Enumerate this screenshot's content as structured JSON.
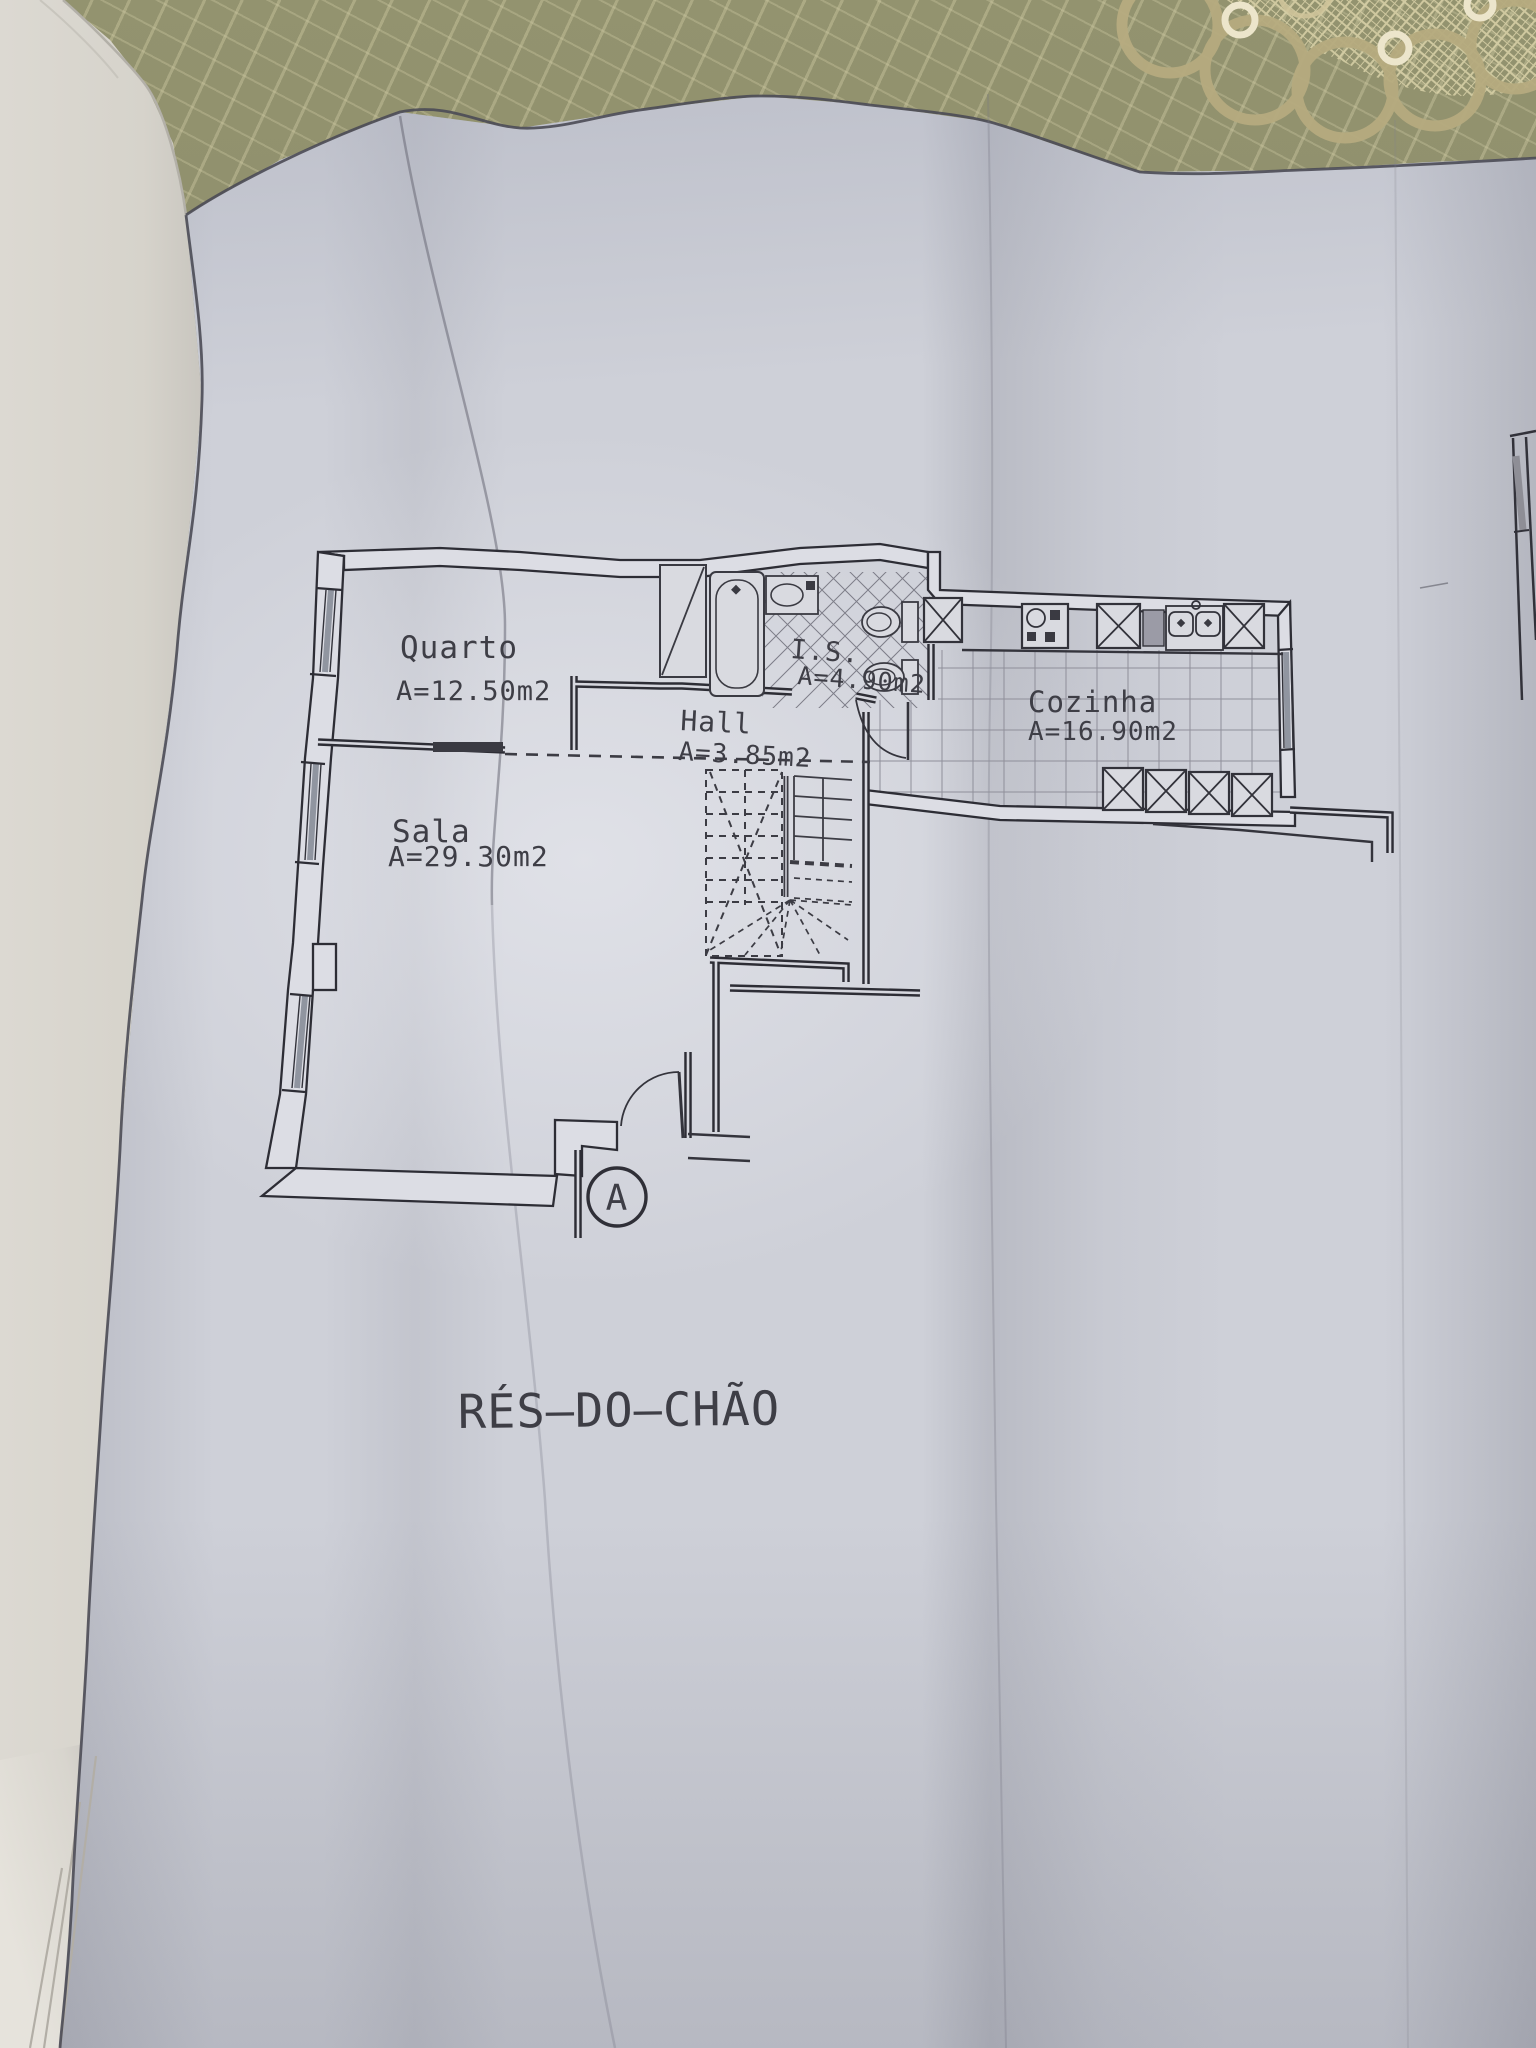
{
  "plan": {
    "title": "RÉS–DO–CHÃO",
    "section_marker": "A",
    "rooms": {
      "quarto": {
        "name": "Quarto",
        "area": "A=12.50m2"
      },
      "sala": {
        "name": "Sala",
        "area": "A=29.30m2"
      },
      "hall": {
        "name": "Hall",
        "area": "A=3.85m2"
      },
      "is": {
        "name": "I.S.",
        "area": "A=4.90m2"
      },
      "cozinha": {
        "name": "Cozinha",
        "area": "A=16.90m2"
      }
    }
  },
  "colors": {
    "ink": "#2d2d35",
    "paper": "#ced0d8",
    "glazing_gray": "#9095a0",
    "fabric_olive": "#8e8e6d",
    "lace_gold": "#b6ab7f",
    "book_page": "#d6d3cb"
  }
}
